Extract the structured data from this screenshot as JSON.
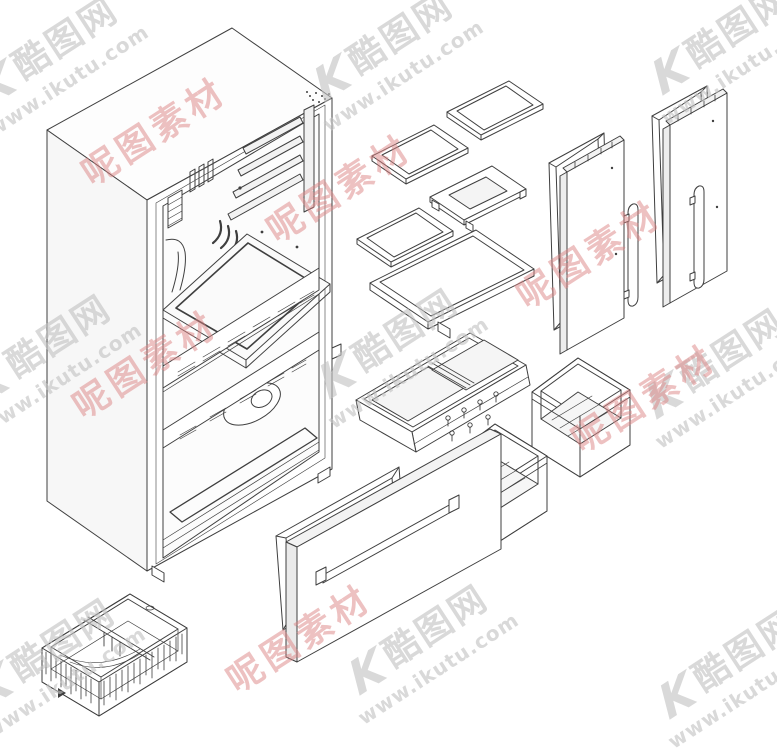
{
  "watermark": {
    "logo_text": "K",
    "brand_text": "酷图网",
    "url_text": "www.ikutu.com",
    "red_text": "呢图素材",
    "gray_color": "#c3c3c3",
    "red_color": "#dd8484"
  },
  "diagram": {
    "type": "exploded-view",
    "subject": "French-door refrigerator exploded parts diagram",
    "line_color": "#3f3f3f",
    "background": "#ffffff",
    "parts": [
      "refrigerator cabinet with interior liner, shelf rails, vents, air duct and freezer compartment",
      "glass shelf (upper right)",
      "glass shelf (upper left)",
      "framed tray shelf",
      "glass shelf (lower left)",
      "wide glass shelf",
      "left door gasket",
      "left refrigerator door with vertical handle",
      "right door gasket",
      "right refrigerator door with vertical handle",
      "drawer cover assembly with twin glass panels and mounting screws",
      "drawer bin (upper right)",
      "drawer bin (center)",
      "freezer door gasket",
      "freezer drawer door with horizontal handle",
      "wire freezer basket with divider"
    ]
  }
}
